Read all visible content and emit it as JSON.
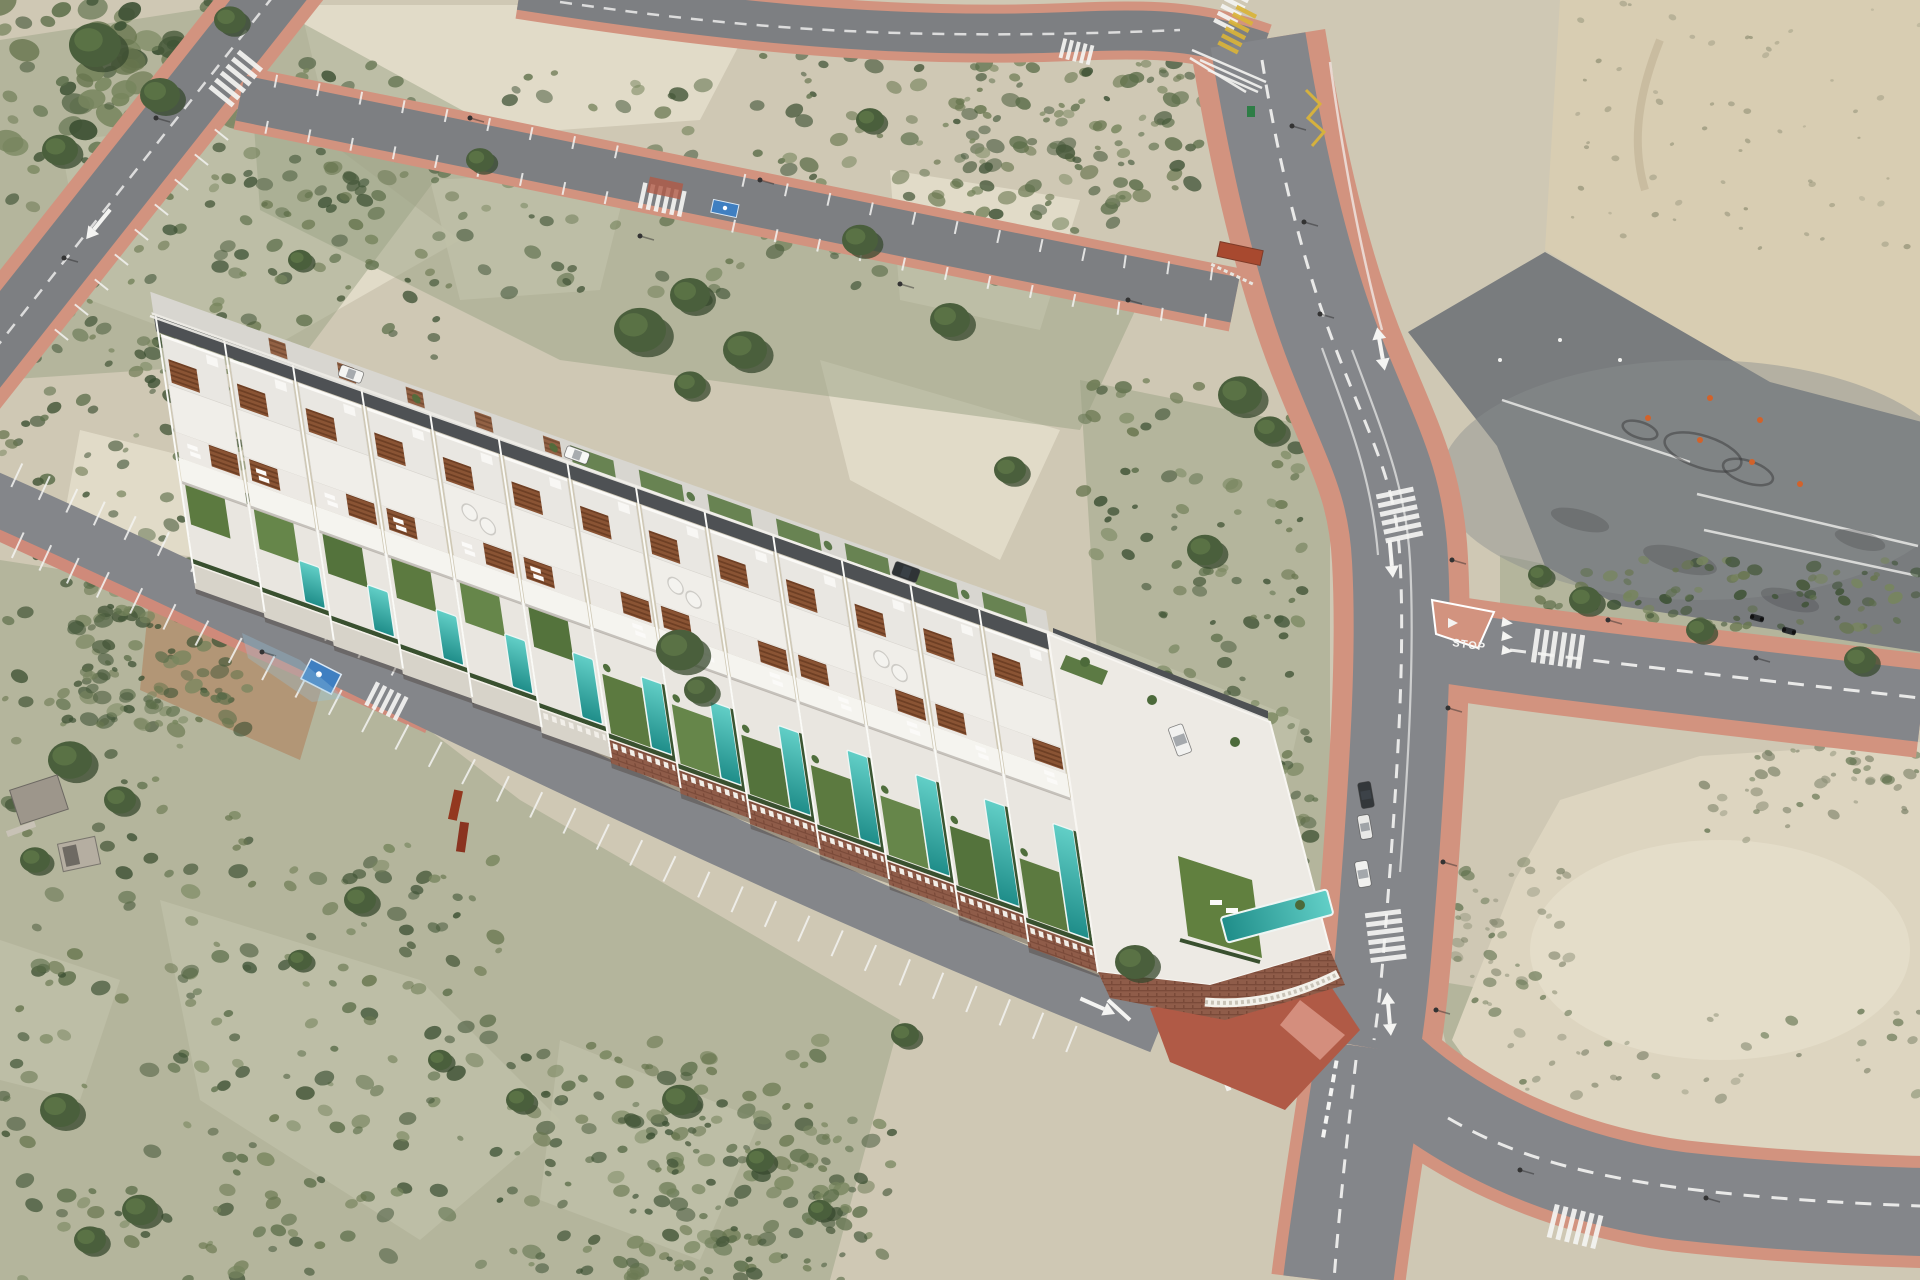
{
  "image": {
    "kind": "aerial-drone-photo",
    "alt": "Aerial drone view of a new development of thirteen white terraced villas with private pools and gardens on a semi-arid hillside, bordered by an access road with parking bays, empty asphalt roads with pink sidewalks, a large driving-practice asphalt lot and sandy scrubland",
    "description": "CGI render of a row of modern white villas with turquoise lap pools, green lawns and wooden pergolas composited onto an aerial photo of bare roads, a paved practice lot and scrub-covered dunes"
  },
  "development": {
    "villa_count": 13,
    "pool_count": 12,
    "roof_terraces": true,
    "skylight_dome_units": 3
  },
  "vehicles": {
    "cars_parked_on_road": 3,
    "cars_inside_development": 3,
    "vans": 1,
    "motorcycles": 2,
    "waste_bins": 1
  },
  "roads": {
    "stop_label": "STOP",
    "crosswalks": 11,
    "yellow_crosswalks": 1,
    "disabled_parking_bays": 2
  },
  "palette": {
    "sand": "#cfc8b4",
    "light_sand": "#e4decb",
    "scrub": "#969c7c",
    "bush_dark": "#46583a",
    "bush_mid": "#5c6e4a",
    "bush_light": "#77855e",
    "asphalt": "#84868a",
    "asphalt_old": "#7d7f82",
    "lot_asphalt": "#797c7e",
    "sidewalk_pink": "#d2937f",
    "marking_white": "#f4f4f2",
    "marking_yellow": "#d9b33a",
    "pool": "#35aca6",
    "lawn": "#5e7c40",
    "roof_white": "#edebe6",
    "pergola_brown": "#8a5434",
    "brick_wall": "#8f5c49",
    "plaza_red": "#b05a46",
    "disabled_bay_blue": "#3f7fc1"
  }
}
